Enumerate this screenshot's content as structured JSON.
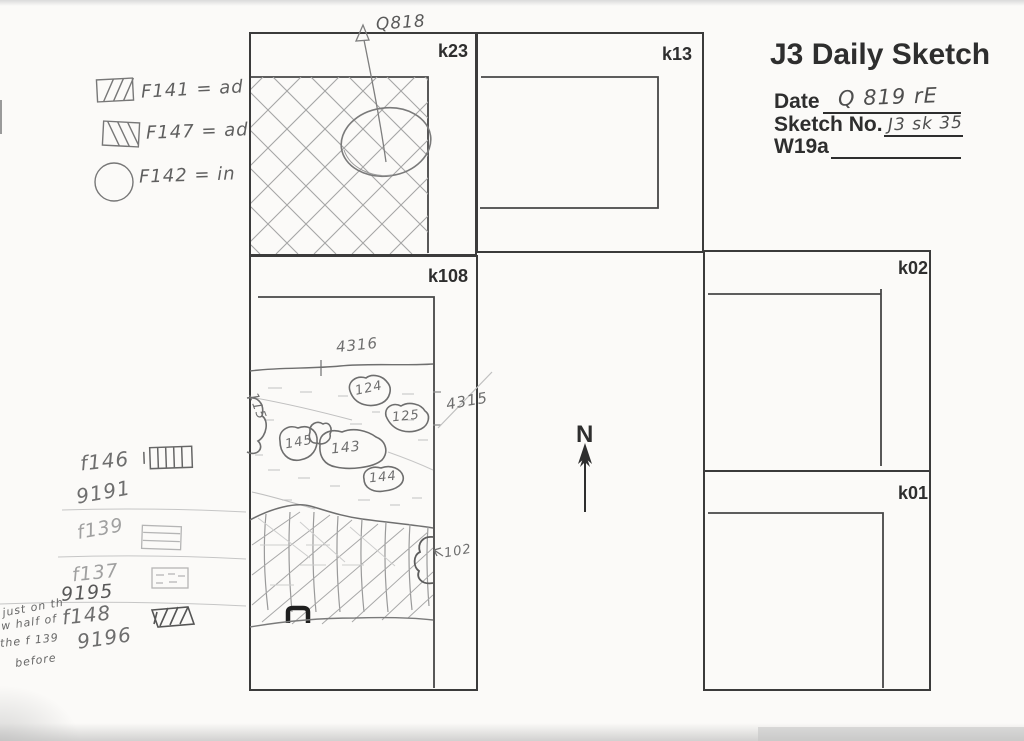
{
  "document": {
    "title": "J3 Daily Sketch",
    "fields": {
      "date": {
        "label": "Date",
        "value": "Q 819 rE"
      },
      "sketch_no": {
        "label": "Sketch No.",
        "value": "J3 sk 35"
      },
      "w19a": {
        "label": "W19a",
        "value": ""
      }
    }
  },
  "legend": {
    "items": [
      {
        "symbol": "forward-diagonal-hatch-swatch",
        "label": "F141 = ad"
      },
      {
        "symbol": "back-diagonal-hatch-swatch",
        "label": "F147 = ad"
      },
      {
        "symbol": "circle-swatch",
        "label": "F142 = in"
      }
    ]
  },
  "grid_squares": [
    {
      "label": "k23"
    },
    {
      "label": "k13"
    },
    {
      "label": "k108"
    },
    {
      "label": "k02"
    },
    {
      "label": "k01"
    }
  ],
  "sketch_annotations": {
    "q818_label": "Q818",
    "north_label": "N",
    "level_top": "4316",
    "level_right": "4315",
    "stone_115": "115",
    "stone_124": "124",
    "stone_125": "125",
    "stone_145": "145",
    "stone_143": "143",
    "stone_144": "144",
    "feature_102": "102"
  },
  "side_notes": {
    "rows": [
      {
        "feature": "f146",
        "find": "9191",
        "symbol": "vertical-lines-swatch"
      },
      {
        "feature": "f139",
        "find": "",
        "symbol": "horizontal-lines-swatch"
      },
      {
        "feature": "f137",
        "find": "9195",
        "symbol": "dashed-lines-swatch"
      },
      {
        "feature": "f148",
        "find": "9196",
        "symbol": "diagonal-lines-swatch"
      }
    ]
  },
  "margin_note": {
    "line1": "just on th",
    "line2": "w half of",
    "line3": "the f 139",
    "line4": "before"
  },
  "colors": {
    "paper": "#fbfaf8",
    "print_ink": "#3b3b3b",
    "pencil": "#8c8c8c",
    "pencil_light": "#b5b5b5"
  }
}
